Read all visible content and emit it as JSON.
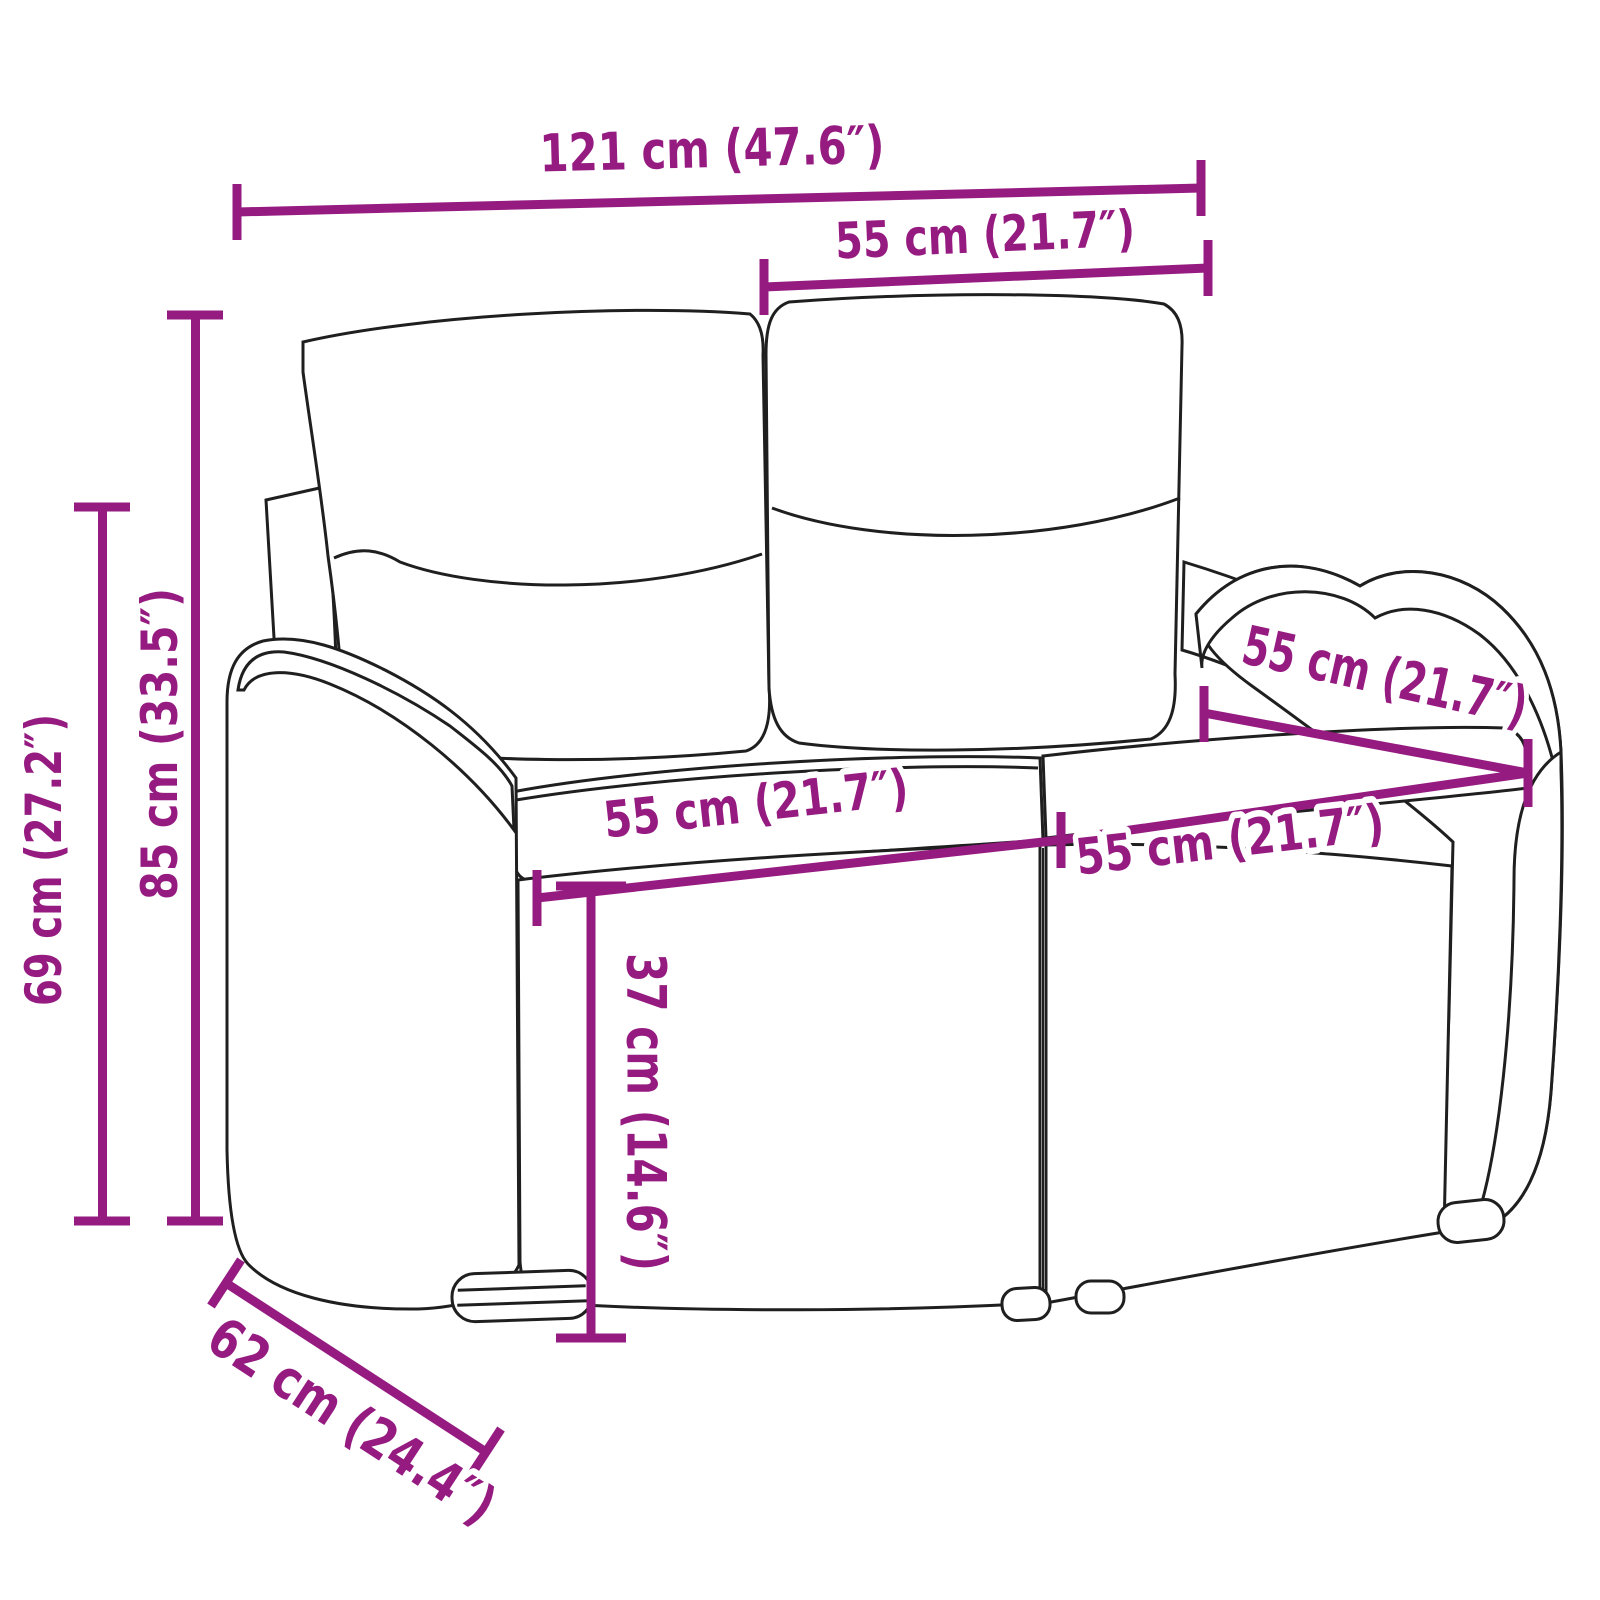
{
  "illustration_name": "two-seater-wicker-garden-bench-line-art",
  "colors": {
    "dimension_accent": "#951b81",
    "line_art": "#1f1f1f",
    "background": "#ffffff"
  },
  "dimensions": {
    "overall_width": "121 cm (47.6″)",
    "backrest_cushion_width": "55 cm (21.7″)",
    "total_height": "85 cm (33.5″)",
    "frame_height": "69 cm (27.2″)",
    "seat_width_left": "55 cm (21.7″)",
    "seat_width_right": "55 cm (21.7″)",
    "seat_depth": "55 cm (21.7″)",
    "seat_height": "37 cm (14.6″)",
    "overall_depth": "62 cm (24.4″)"
  }
}
